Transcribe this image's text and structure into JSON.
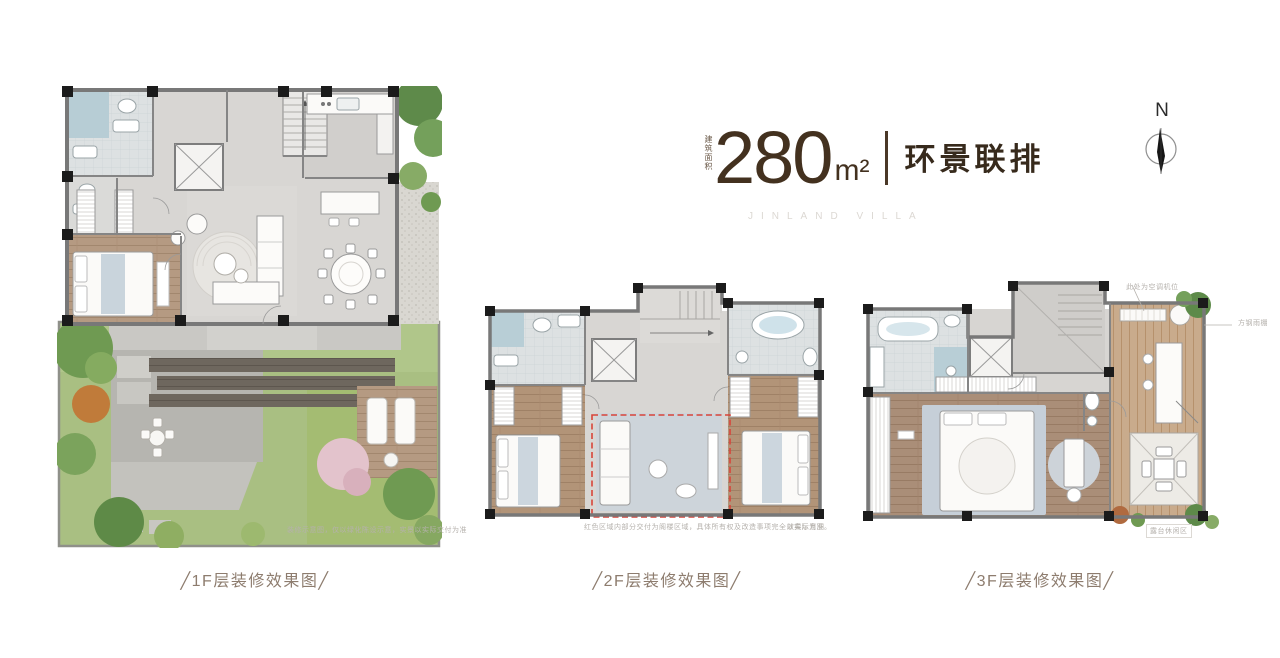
{
  "header": {
    "area_label": "建筑面积",
    "area_value": "280",
    "area_unit": "m²",
    "product_name": "环景联排",
    "subtitle_en": "JINLAND VILLA"
  },
  "compass": {
    "label": "N"
  },
  "plans": {
    "f1": {
      "caption": "╱1F层装修效果图╱",
      "note": "装修示意图，仅以绿化陈设示意，实景以实际交付为准"
    },
    "f2": {
      "caption": "╱2F层装修效果图╱",
      "note_left": "红色区域内部分交付为阁楼区域，具体所有权及改造事项完全以实际为准。",
      "note_right": "效果示意图"
    },
    "f3": {
      "caption": "╱3F层装修效果图╱",
      "annotation_ac": "此处为空调机位",
      "annotation_canopy": "方钢雨棚",
      "note": "露台休闲区"
    }
  },
  "colors": {
    "accent_brown": "#43311f",
    "caption_text": "#8d7c6e",
    "highlight_red": "#d8453a",
    "wood": "#b59a82",
    "lawn_green": "#a9bf82"
  }
}
